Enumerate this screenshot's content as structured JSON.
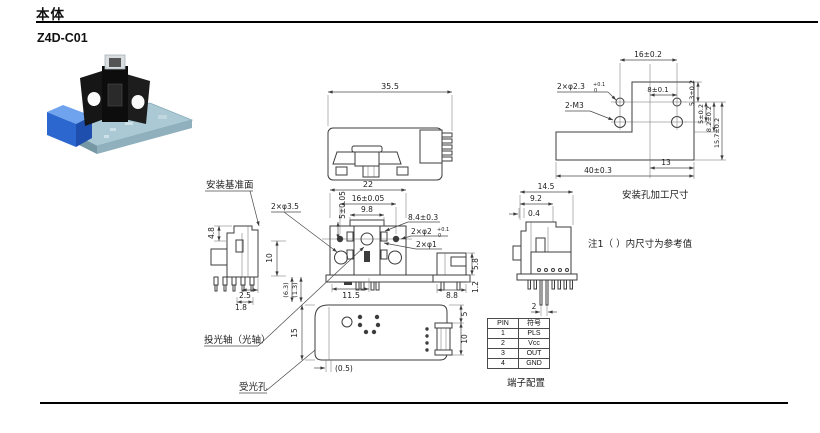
{
  "page": {
    "section_title": "本体",
    "model": "Z4D-C01"
  },
  "colors": {
    "line": "#3c3c3c",
    "pcb": "#aac9d4",
    "connector_blue": "#2c67cf",
    "housing_black": "#141414"
  },
  "labels": {
    "mounting_ref_surface": "安装基准面",
    "emitter_axis": "投光轴（光轴）",
    "receiver_hole": "受光孔",
    "mounting_hole_caption": "安装孔加工尺寸",
    "note1": "注1（ ）内尺寸为参考值",
    "terminal_caption": "端子配置"
  },
  "dims": {
    "top_width": "35.5",
    "front_width": "22",
    "hole_pitch": "16±0.05",
    "cap_width": "9.8",
    "front_height_tol": "5±0.05",
    "d_84": "8.4±0.3",
    "phi2_label": "2×φ2",
    "phi2_tol_top": "+0.1",
    "phi2_tol_bot": "0",
    "phi1_label": "2×φ1",
    "d_115": "11.5",
    "d_88": "8.8",
    "d_58": "5.8",
    "d_12": "1.2",
    "d_48": "4.8",
    "d_25": "2.5",
    "d_18": "1.8",
    "phi35_label": "2×φ3.5",
    "d_10": "10",
    "ref_63": "(6.3)",
    "ref_13": "(1.3)",
    "d_15": "15",
    "ref_05": "(0.5)",
    "right_5": "5",
    "right_10": "10",
    "mh_16": "16±0.2",
    "phi23_label": "2×φ2.3",
    "phi23_tol_top": "+0.1",
    "phi23_tol_bot": "0",
    "m3_label": "2-M3",
    "mh_8": "8±0.1",
    "mh_53": "5.3±0.2",
    "mh_5": "5±0.2",
    "mh_82": "8.2±0.2",
    "mh_157": "15.7±0.2",
    "mh_13": "13",
    "mh_40": "40±0.3",
    "sv_145": "14.5",
    "sv_92": "9.2",
    "sv_04": "0.4",
    "sv_2": "2"
  },
  "pin_table": {
    "headers": [
      "PIN",
      "符号"
    ],
    "rows": [
      [
        "1",
        "PLS"
      ],
      [
        "2",
        "Vcc"
      ],
      [
        "3",
        "OUT"
      ],
      [
        "4",
        "GND"
      ]
    ]
  }
}
